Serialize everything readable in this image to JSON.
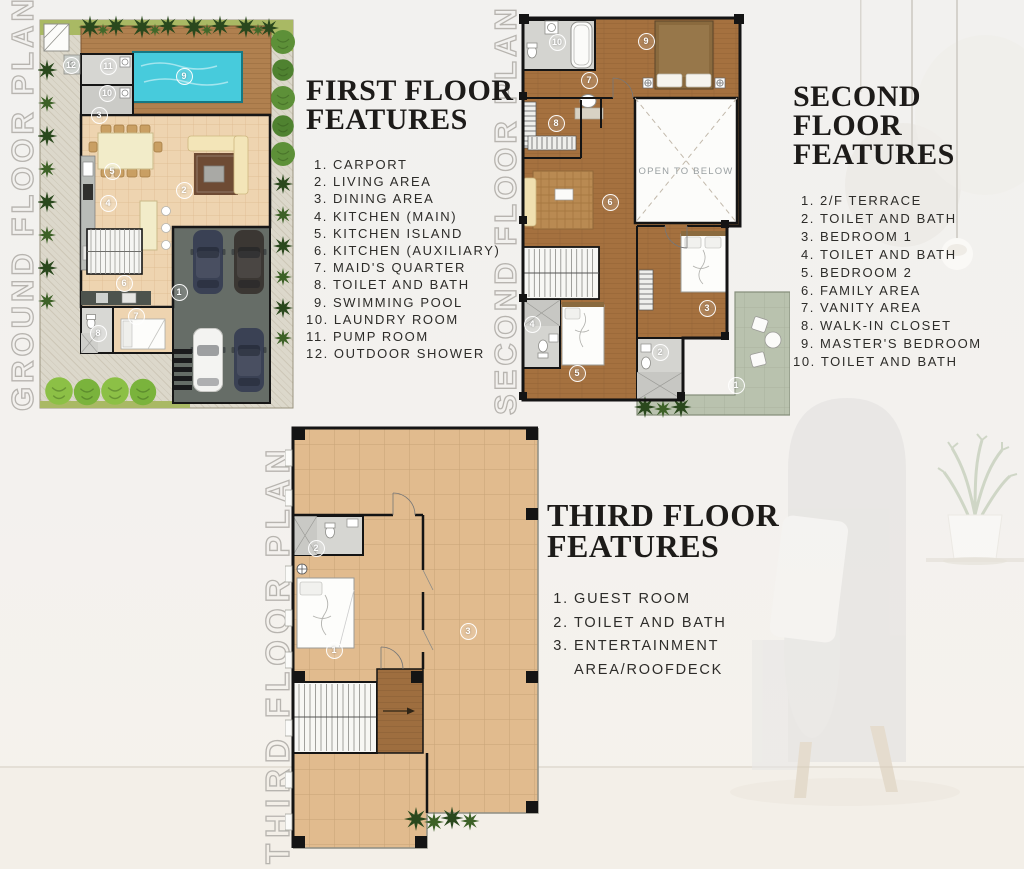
{
  "sections": {
    "first": {
      "title_line1": "FIRST FLOOR",
      "title_line2": "FEATURES",
      "items": [
        "CARPORT",
        "LIVING AREA",
        "DINING AREA",
        "KITCHEN (MAIN)",
        "KITCHEN ISLAND",
        "KITCHEN (AUXILIARY)",
        "MAID'S QUARTER",
        "TOILET AND BATH",
        "SWIMMING POOL",
        "LAUNDRY ROOM",
        "PUMP ROOM",
        "OUTDOOR SHOWER"
      ]
    },
    "second": {
      "title_line1": "SECOND FLOOR",
      "title_line2": "FEATURES",
      "items": [
        "2/F TERRACE",
        "TOILET AND BATH",
        "BEDROOM 1",
        "TOILET AND BATH",
        "BEDROOM 2",
        "FAMILY AREA",
        "VANITY AREA",
        "WALK-IN CLOSET",
        "MASTER'S BEDROOM",
        "TOILET AND BATH"
      ]
    },
    "third": {
      "title_line1": "THIRD FLOOR",
      "title_line2": "FEATURES",
      "items": [
        "GUEST ROOM",
        "TOILET AND BATH",
        "ENTERTAINMENT\nAREA/ROOFDECK"
      ]
    }
  },
  "plans": {
    "ground": {
      "label": "GROUND FLOOR PLAN",
      "markers": [
        {
          "n": "1",
          "x": 141,
          "y": 284
        },
        {
          "n": "2",
          "x": 146,
          "y": 182
        },
        {
          "n": "3",
          "x": 61,
          "y": 107
        },
        {
          "n": "4",
          "x": 70,
          "y": 195
        },
        {
          "n": "5",
          "x": 74,
          "y": 163
        },
        {
          "n": "6",
          "x": 86,
          "y": 275
        },
        {
          "n": "7",
          "x": 98,
          "y": 308
        },
        {
          "n": "8",
          "x": 60,
          "y": 325
        },
        {
          "n": "9",
          "x": 146,
          "y": 68
        },
        {
          "n": "10",
          "x": 69,
          "y": 85
        },
        {
          "n": "11",
          "x": 70,
          "y": 58
        },
        {
          "n": "12",
          "x": 33,
          "y": 57
        }
      ]
    },
    "second": {
      "label": "SECOND FLOOR PLAN",
      "open_label": "OPEN TO BELOW",
      "markers": [
        {
          "n": "1",
          "x": 231,
          "y": 377
        },
        {
          "n": "2",
          "x": 155,
          "y": 344
        },
        {
          "n": "3",
          "x": 202,
          "y": 300
        },
        {
          "n": "4",
          "x": 27,
          "y": 316
        },
        {
          "n": "5",
          "x": 72,
          "y": 365
        },
        {
          "n": "6",
          "x": 105,
          "y": 194
        },
        {
          "n": "7",
          "x": 84,
          "y": 72
        },
        {
          "n": "8",
          "x": 51,
          "y": 115
        },
        {
          "n": "9",
          "x": 141,
          "y": 33
        },
        {
          "n": "10",
          "x": 52,
          "y": 34
        }
      ]
    },
    "third": {
      "label": "THIRD FLOOR PLAN",
      "markers": [
        {
          "n": "1",
          "x": 49,
          "y": 230
        },
        {
          "n": "2",
          "x": 31,
          "y": 128
        },
        {
          "n": "3",
          "x": 183,
          "y": 211
        }
      ]
    }
  },
  "palette": {
    "background": "#f2f1ee",
    "heading_text": "#1d1b19",
    "list_text": "#2d2c29",
    "outline_label": "#b7b4af",
    "marker": "#ffffff",
    "pool_water": "#47cbdc",
    "wood_deck": "#b0804f",
    "wood_floor": "#a5713f",
    "interior_tile": "#eed4b0",
    "roofdeck_tile": "#e1bb8e",
    "terrace": "#b9c2ae",
    "carport_concrete": "#666d67",
    "grass": "#a9b964",
    "tree_dark": "#2a481d",
    "wall": "#141414"
  }
}
